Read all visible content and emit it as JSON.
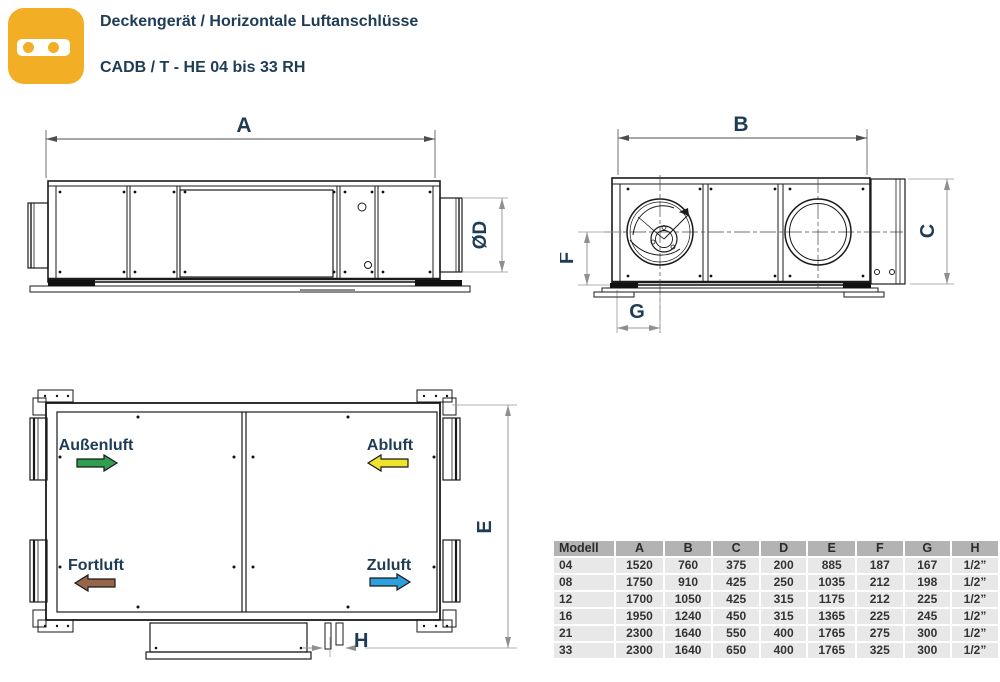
{
  "header": {
    "title": "Deckengerät / Horizontale Luftanschlüsse",
    "subtitle": "CADB / T - HE 04 bis 33 RH",
    "icon_color": "#F2AE24"
  },
  "diagrams": {
    "side_view": {
      "dim_a": "A",
      "dim_d": "ØD"
    },
    "end_view": {
      "dim_b": "B",
      "dim_c": "C",
      "dim_f": "F",
      "dim_g": "G"
    },
    "top_view": {
      "dim_e": "E",
      "dim_h": "H",
      "flows": {
        "aussenluft": {
          "label": "Außenluft",
          "color": "#2F9E4E",
          "direction": "right"
        },
        "abluft": {
          "label": "Abluft",
          "color": "#F0E32B",
          "direction": "left"
        },
        "fortluft": {
          "label": "Fortluft",
          "color": "#96664A",
          "direction": "left"
        },
        "zuluft": {
          "label": "Zuluft",
          "color": "#2D9FDC",
          "direction": "right"
        }
      }
    }
  },
  "table": {
    "headers": [
      "Modell",
      "A",
      "B",
      "C",
      "D",
      "E",
      "F",
      "G",
      "H"
    ],
    "rows": [
      [
        "04",
        "1520",
        "760",
        "375",
        "200",
        "885",
        "187",
        "167",
        "1/2”"
      ],
      [
        "08",
        "1750",
        "910",
        "425",
        "250",
        "1035",
        "212",
        "198",
        "1/2”"
      ],
      [
        "12",
        "1700",
        "1050",
        "425",
        "315",
        "1175",
        "212",
        "225",
        "1/2”"
      ],
      [
        "16",
        "1950",
        "1240",
        "450",
        "315",
        "1365",
        "225",
        "245",
        "1/2”"
      ],
      [
        "21",
        "2300",
        "1640",
        "550",
        "400",
        "1765",
        "275",
        "300",
        "1/2”"
      ],
      [
        "33",
        "2300",
        "1640",
        "650",
        "400",
        "1765",
        "325",
        "300",
        "1/2”"
      ]
    ]
  },
  "colors": {
    "accent_navy": "#1E3C55",
    "icon_orange": "#F2AE24",
    "table_header_bg": "#B3B3B3",
    "table_row_bg": "#E8E8E8"
  }
}
